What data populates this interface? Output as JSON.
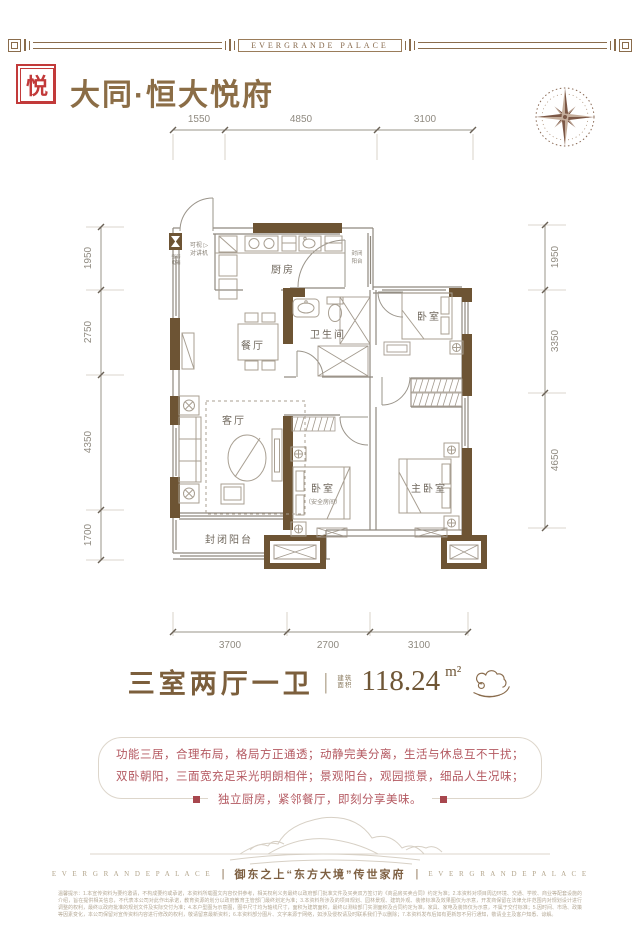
{
  "border": {
    "brand": "EVERGRANDE  PALACE"
  },
  "header": {
    "seal_char": "悦",
    "title": "大同·恒大悦府"
  },
  "plan": {
    "dims_top": [
      "1550",
      "4850",
      "3100"
    ],
    "dims_left": [
      "1950",
      "2750",
      "4350",
      "1700"
    ],
    "dims_right": [
      "1950",
      "3350",
      "4650"
    ],
    "dims_bottom": [
      "3700",
      "2700",
      "3100"
    ],
    "labels": {
      "kitchen": "厨房",
      "dining": "餐厅",
      "bath": "卫生间",
      "bedroom1": "卧室",
      "living": "客厅",
      "bedroom2": "卧室",
      "bedroom2_note": "（安全房间）",
      "master": "主卧室",
      "balcony": "封闭阳台",
      "utility_balcony_1": "封闭",
      "utility_balcony_2": "阳台",
      "intercom_1": "可视 ▷",
      "intercom_2": "对讲机",
      "meter_1": "强弱",
      "meter_2": "电箱"
    }
  },
  "summary": {
    "layout": "三室两厅一卫",
    "divider": "|",
    "area_label_1": "建筑",
    "area_label_2": "面积",
    "area_value": "118.24",
    "area_unit": "m²"
  },
  "description": {
    "line1": "功能三居，合理布局，格局方正通透；动静完美分离，生活与休息互不干扰；",
    "line2": "双卧朝阳，三面宽充足采光明朗相伴；景观阳台，观园揽景，细品人生况味；",
    "line3": "独立厨房，紧邻餐厅，即刻分享美味。"
  },
  "footer": {
    "brand": "E V E R G R A N D E      P A L A C E",
    "separator": "|",
    "tagline": "御东之上“东方大境”传世家府",
    "disclaimer": "温馨提示：1.本宣传资料为要约邀请，不构成要约或承诺，本资料所载图文内容仅供参考，相关权利义务最终以政府部门批准文件及买卖双方签订的《商品房买卖合同》约定为准；2.本资料对项目周边环境、交通、学校、商业等配套设施的介绍，旨在提供相关信息，不代表本公司对此作出承诺，教育资源的划分以政府教育主管部门最终划定为准；3.本资料所涉及的项目规划、园林景观、建筑外观、装修标准及效果图仅为示意，开发商保留在法律允许范围内对规划设计进行调整的权利，最终以政府批准的规划文件及实际交付为准；4.本户型图为示意图，图中尺寸均为轴线尺寸，面积为建筑面积，最终以测绘部门实测面积及合同约定为准，家具、家电及装饰仅为示意，不属于交付标准；5.因时间、市场、政策等因素变化，本公司保留对宣传资料内容进行修改的权利，敬请留意最新资料；6.本资料部分图片、文字来源于网络，如涉及侵权请及时联系我们予以删除；7.本资料发布后如有更新恕不另行通知，敬请业主及客户知悉、谅解。"
  }
}
